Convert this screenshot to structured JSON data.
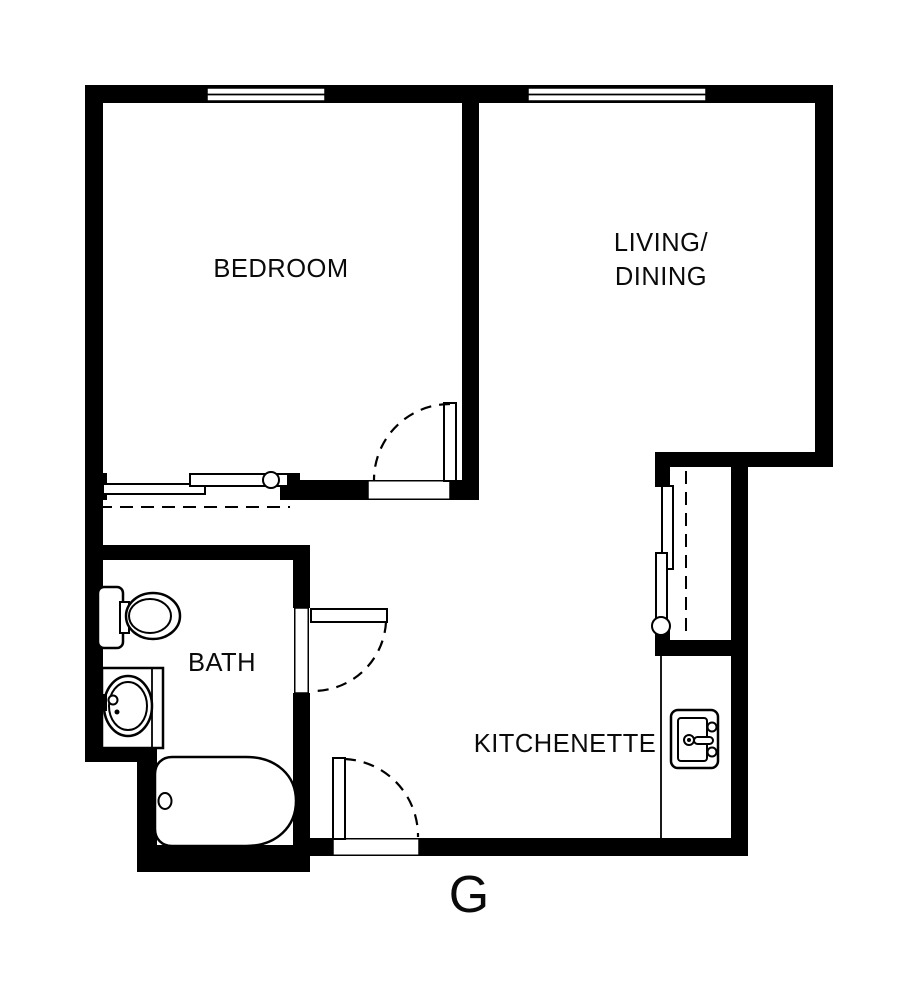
{
  "colors": {
    "background": "#ffffff",
    "walls": "#000000",
    "lines": "#000000",
    "text": "#0a0a0a"
  },
  "floorplan": {
    "unit_label": "G",
    "rooms": {
      "bedroom": {
        "label": "BEDROOM"
      },
      "living_dining": {
        "line1": "LIVING/",
        "line2": "DINING"
      },
      "bath": {
        "label": "BATH"
      },
      "kitchenette": {
        "label": "KITCHENETTE"
      }
    },
    "windows": [
      "bedroom-window",
      "living-window"
    ],
    "doors": [
      "bedroom-door",
      "bath-door",
      "entry-door"
    ],
    "closets": [
      "bedroom-closet-sliding-doors",
      "hall-closet-sliding-doors"
    ],
    "fixtures": [
      "toilet",
      "vanity-sink",
      "bathtub",
      "kitchen-sink"
    ]
  }
}
